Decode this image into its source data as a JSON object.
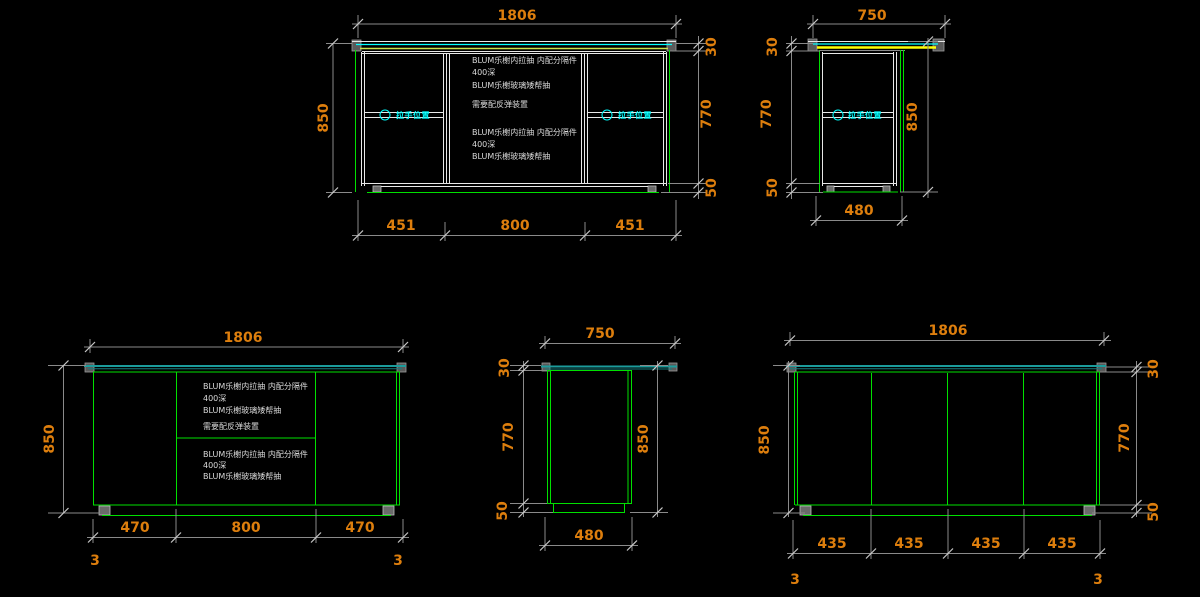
{
  "colors": {
    "background": "#000000",
    "dimension_text_orange": "#dd7e0d",
    "dimension_line_gray": "#8a8a8a",
    "cabinet_line_white": "#e8e8e8",
    "cabinet_line_green": "#00e000",
    "countertop_cyan": "#00ffff",
    "countertop_teal": "#1b9c9c",
    "countertop_highlight_yellow": "#ffff00",
    "handle_label_cyan": "#00ffff",
    "note_text_gray": "#d9d9d9"
  },
  "views": {
    "front_with_counter": {
      "width_dim": "1806",
      "height_dim": "850",
      "side_dims": {
        "top": "30",
        "middle": "770",
        "bottom": "50"
      },
      "bottom_dims": [
        "451",
        "800",
        "451"
      ],
      "handle_label": "拉手位置",
      "notes_upper": [
        "BLUM乐榭内拉抽 内配分隔件",
        "400深",
        "BLUM乐榭玻璃矮帮抽",
        "需要配反弹装置"
      ],
      "notes_lower": [
        "BLUM乐榭内拉抽 内配分隔件",
        "400深",
        "BLUM乐榭玻璃矮帮抽"
      ]
    },
    "side_with_counter": {
      "width_dim": "750",
      "height_dim": "850",
      "side_dims": {
        "top": "30",
        "middle": "770",
        "bottom": "50"
      },
      "bottom_dim": "480",
      "handle_label": "拉手位置"
    },
    "front_plain": {
      "width_dim": "1806",
      "height_dim": "850",
      "bottom_dims": [
        "470",
        "800",
        "470"
      ],
      "section_marks": [
        "3",
        "3"
      ],
      "notes_upper": [
        "BLUM乐榭内拉抽 内配分隔件",
        "400深",
        "BLUM乐榭玻璃矮帮抽",
        "需要配反弹装置"
      ],
      "notes_lower": [
        "BLUM乐榭内拉抽 内配分隔件",
        "400深",
        "BLUM乐榭玻璃矮帮抽"
      ]
    },
    "side_plain": {
      "width_dim": "750",
      "height_dim": "850",
      "side_dims": {
        "top": "30",
        "middle": "770",
        "bottom": "50"
      },
      "bottom_dim": "480"
    },
    "back_plain": {
      "width_dim": "1806",
      "height_dim": "850",
      "side_dims": {
        "top": "30",
        "middle": "770",
        "bottom": "50"
      },
      "bottom_dims": [
        "435",
        "435",
        "435",
        "435"
      ],
      "section_marks": [
        "3",
        "3"
      ]
    }
  }
}
